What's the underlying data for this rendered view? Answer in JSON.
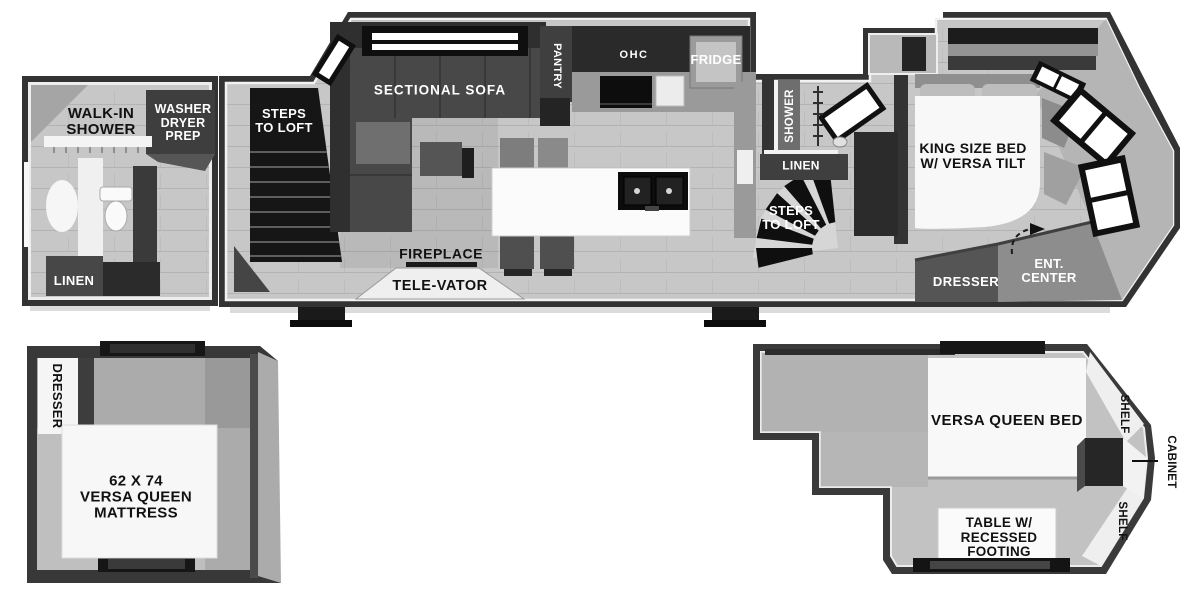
{
  "colors": {
    "wall": "#333333",
    "floor": "#c7c7c7",
    "furniture_dark": "#2f2f2f",
    "white_fixture": "#f8f8f8"
  },
  "main_floor": {
    "labels": {
      "walk_in_shower": "WALK-IN\nSHOWER",
      "washer_dryer_prep": "WASHER\nDRYER\nPREP",
      "linen_front": "LINEN",
      "steps_to_loft_left": "STEPS\nTO LOFT",
      "sectional_sofa": "SECTIONAL SOFA",
      "pantry": "PANTRY",
      "ohc": "OHC",
      "fridge": "FRIDGE",
      "shower": "SHOWER",
      "linen_mid": "LINEN",
      "steps_to_loft_right": "STEPS\nTO LOFT",
      "fireplace": "FIREPLACE",
      "tele_vator": "TELE-VATOR",
      "king_bed": "KING SIZE BED\nW/ VERSA TILT",
      "dresser": "DRESSER",
      "ent_center": "ENT.\nCENTER"
    }
  },
  "loft_front": {
    "labels": {
      "dresser": "DRESSER",
      "mattress": "62 X 74\nVERSA QUEEN\nMATTRESS"
    }
  },
  "loft_rear": {
    "labels": {
      "bed": "VERSA QUEEN BED",
      "shelf_top": "SHELF",
      "cabinet": "CABINET",
      "shelf_bottom": "SHELF",
      "table": "TABLE W/\nRECESSED\nFOOTING"
    }
  }
}
